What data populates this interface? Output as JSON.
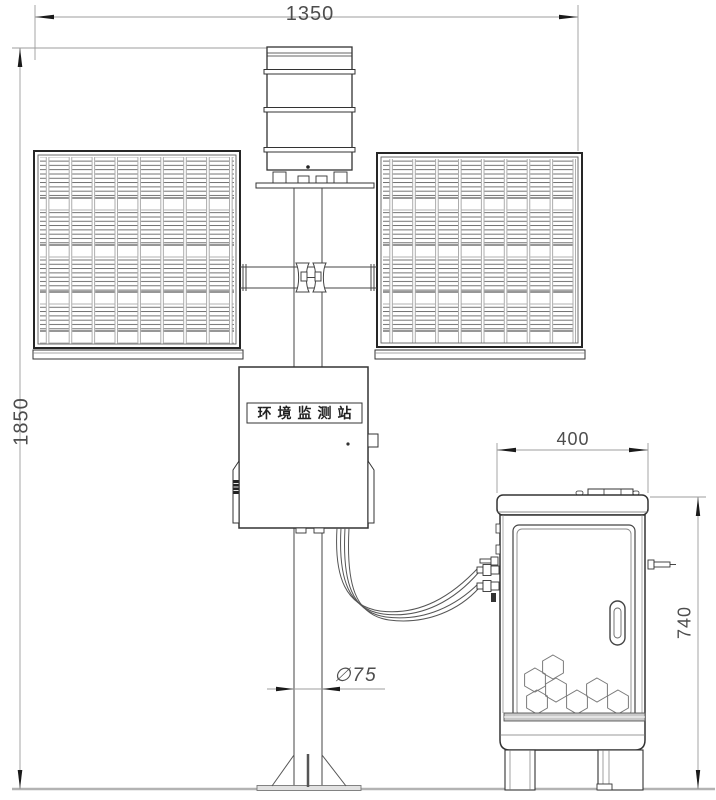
{
  "drawing": {
    "station_label": "环境监测站",
    "dimensions": {
      "overall_width": "1350",
      "overall_height": "1850",
      "cabinet_width": "400",
      "cabinet_height": "740",
      "pole_diameter": "∅75"
    }
  }
}
